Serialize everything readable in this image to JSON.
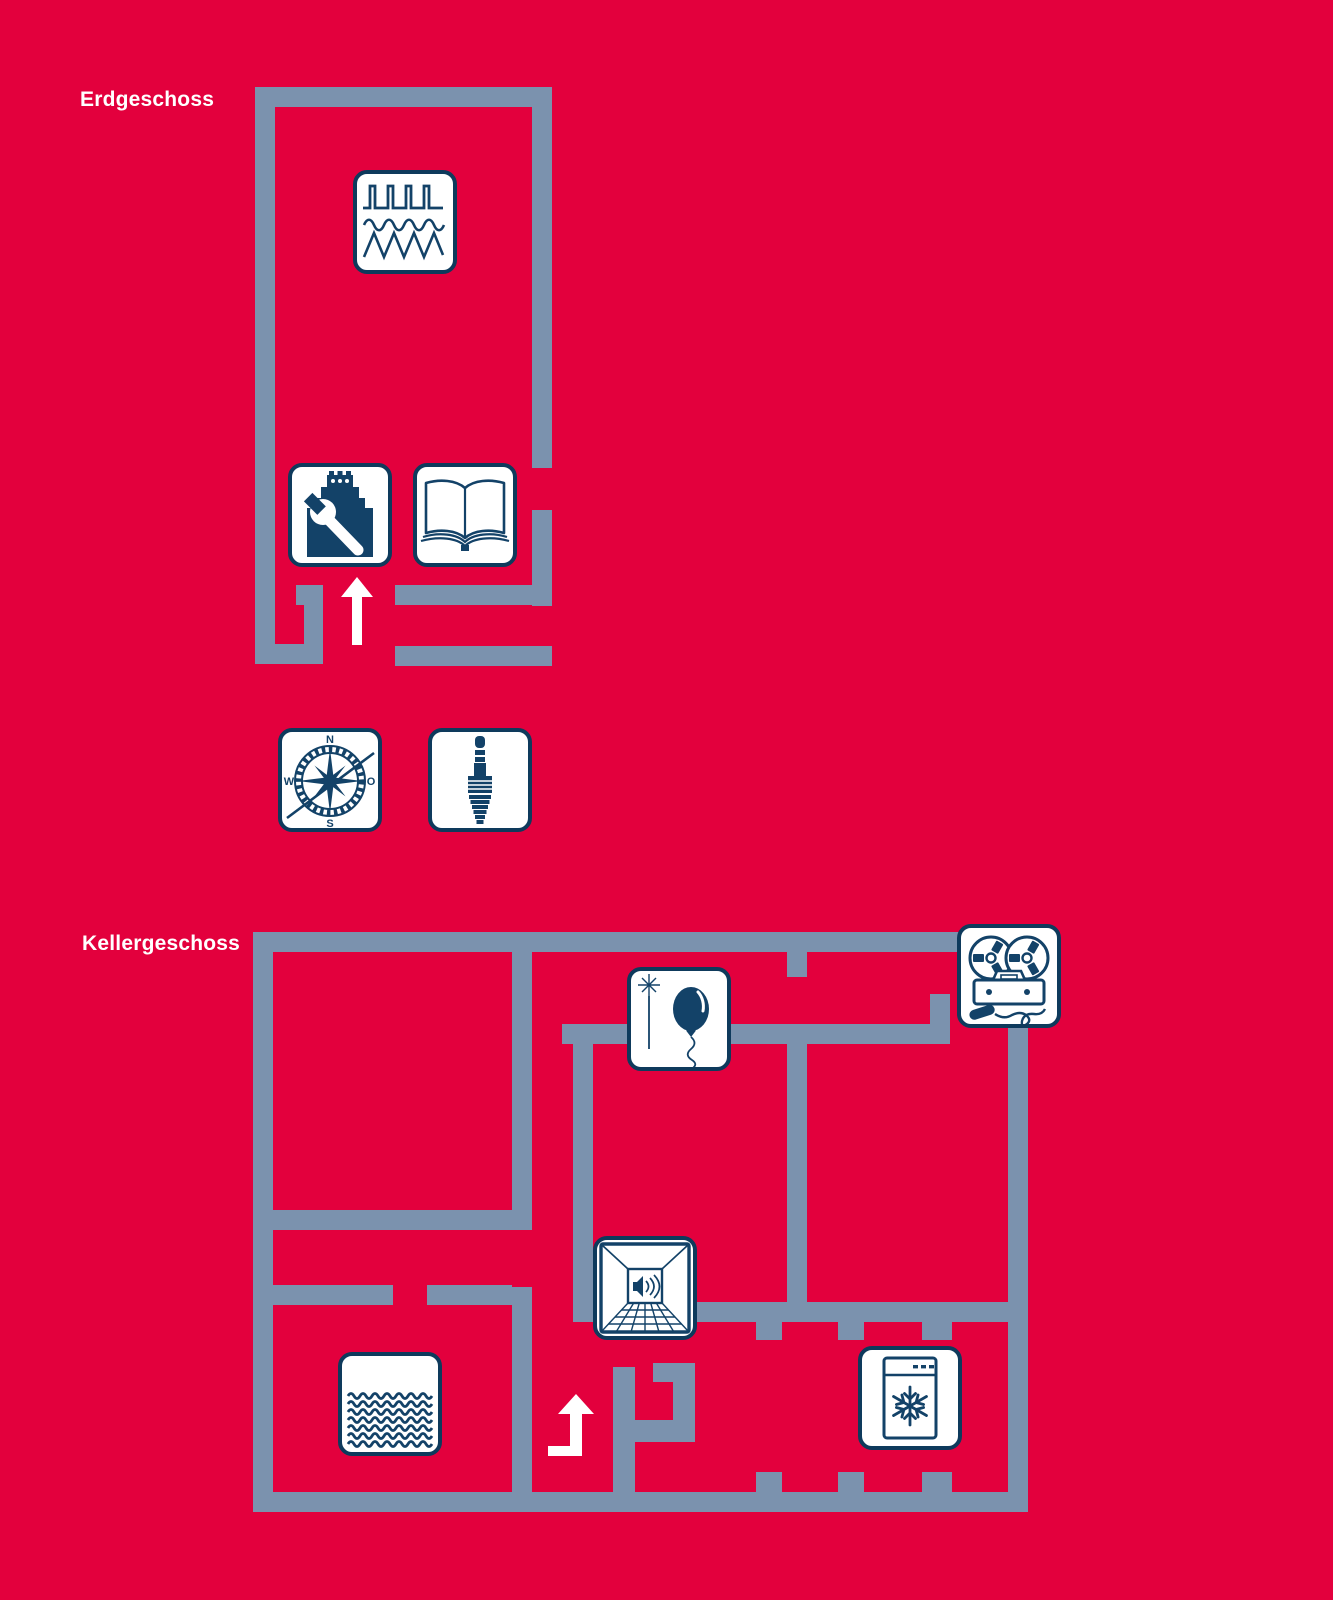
{
  "page": {
    "background": "#e3003d",
    "type": "building-floor-plan-map"
  },
  "colors": {
    "background_red": "#e3003d",
    "wall_blue_gray": "#7b92ae",
    "icon_stroke_navy": "#134268",
    "icon_border_navy": "#0e3a5c",
    "icon_background": "#ffffff",
    "label_text": "#ffffff",
    "arrow_white": "#ffffff"
  },
  "floors": [
    {
      "id": "erdgeschoss",
      "label": "Erdgeschoss",
      "icons": [
        {
          "name": "waveform-signals-icon"
        },
        {
          "name": "tower-wrench-workshop-icon"
        },
        {
          "name": "open-book-icon"
        },
        {
          "name": "stairs-up-arrow"
        }
      ]
    },
    {
      "id": "kellergeschoss",
      "label": "Kellergeschoss",
      "icons": [
        {
          "name": "magic-wand-balloon-icon"
        },
        {
          "name": "reel-tape-recorder-microphone-icon"
        },
        {
          "name": "speaker-corridor-icon"
        },
        {
          "name": "water-basin-icon"
        },
        {
          "name": "freezer-snowflake-icon"
        },
        {
          "name": "bent-stairs-up-arrow"
        }
      ]
    }
  ],
  "standalone_icons": [
    {
      "name": "compass-rose-icon"
    },
    {
      "name": "audio-jack-icon"
    }
  ],
  "compass": {
    "n": "N",
    "w": "W",
    "o": "O",
    "s": "S"
  }
}
